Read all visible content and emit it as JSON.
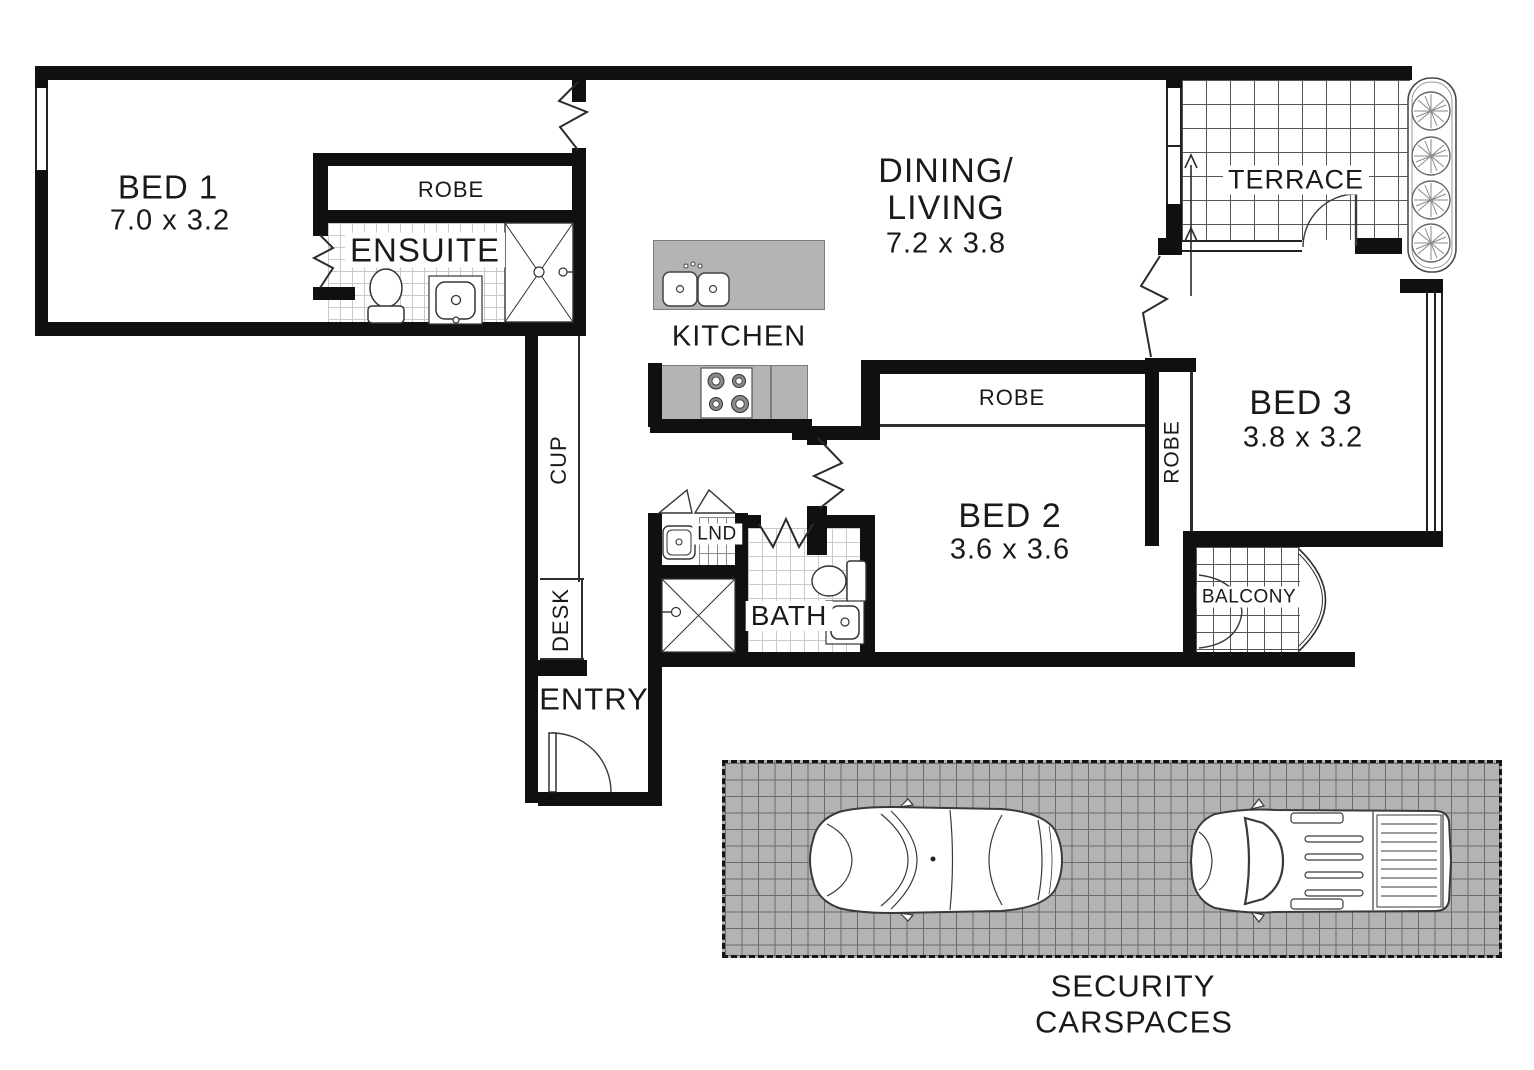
{
  "labels": {
    "bed1": {
      "name": "BED 1",
      "dims": "7.0 x 3.2"
    },
    "robe1": "ROBE",
    "ensuite": "ENSUITE",
    "dining": {
      "line1": "DINING/",
      "line2": "LIVING",
      "dims": "7.2 x 3.8"
    },
    "kitchen": "KITCHEN",
    "terrace": "TERRACE",
    "bed3": {
      "name": "BED 3",
      "dims": "3.8 x 3.2"
    },
    "robe3": "ROBE",
    "robe2": "ROBE",
    "bed2": {
      "name": "BED 2",
      "dims": "3.6 x 3.6"
    },
    "bath": "BATH",
    "lnd": "LND",
    "cup": "CUP",
    "desk": "DESK",
    "entry": "ENTRY",
    "balcony": "BALCONY",
    "carspaces": {
      "line1": "SECURITY",
      "line2": "CARSPACES"
    }
  },
  "colors": {
    "wall": "#101010",
    "text": "#1a1a1a",
    "fixture_gray": "#b4b4b4",
    "carspace_gray": "#b3b3b3",
    "grid_line": "#555555",
    "tile_line": "#c9c9c9"
  }
}
